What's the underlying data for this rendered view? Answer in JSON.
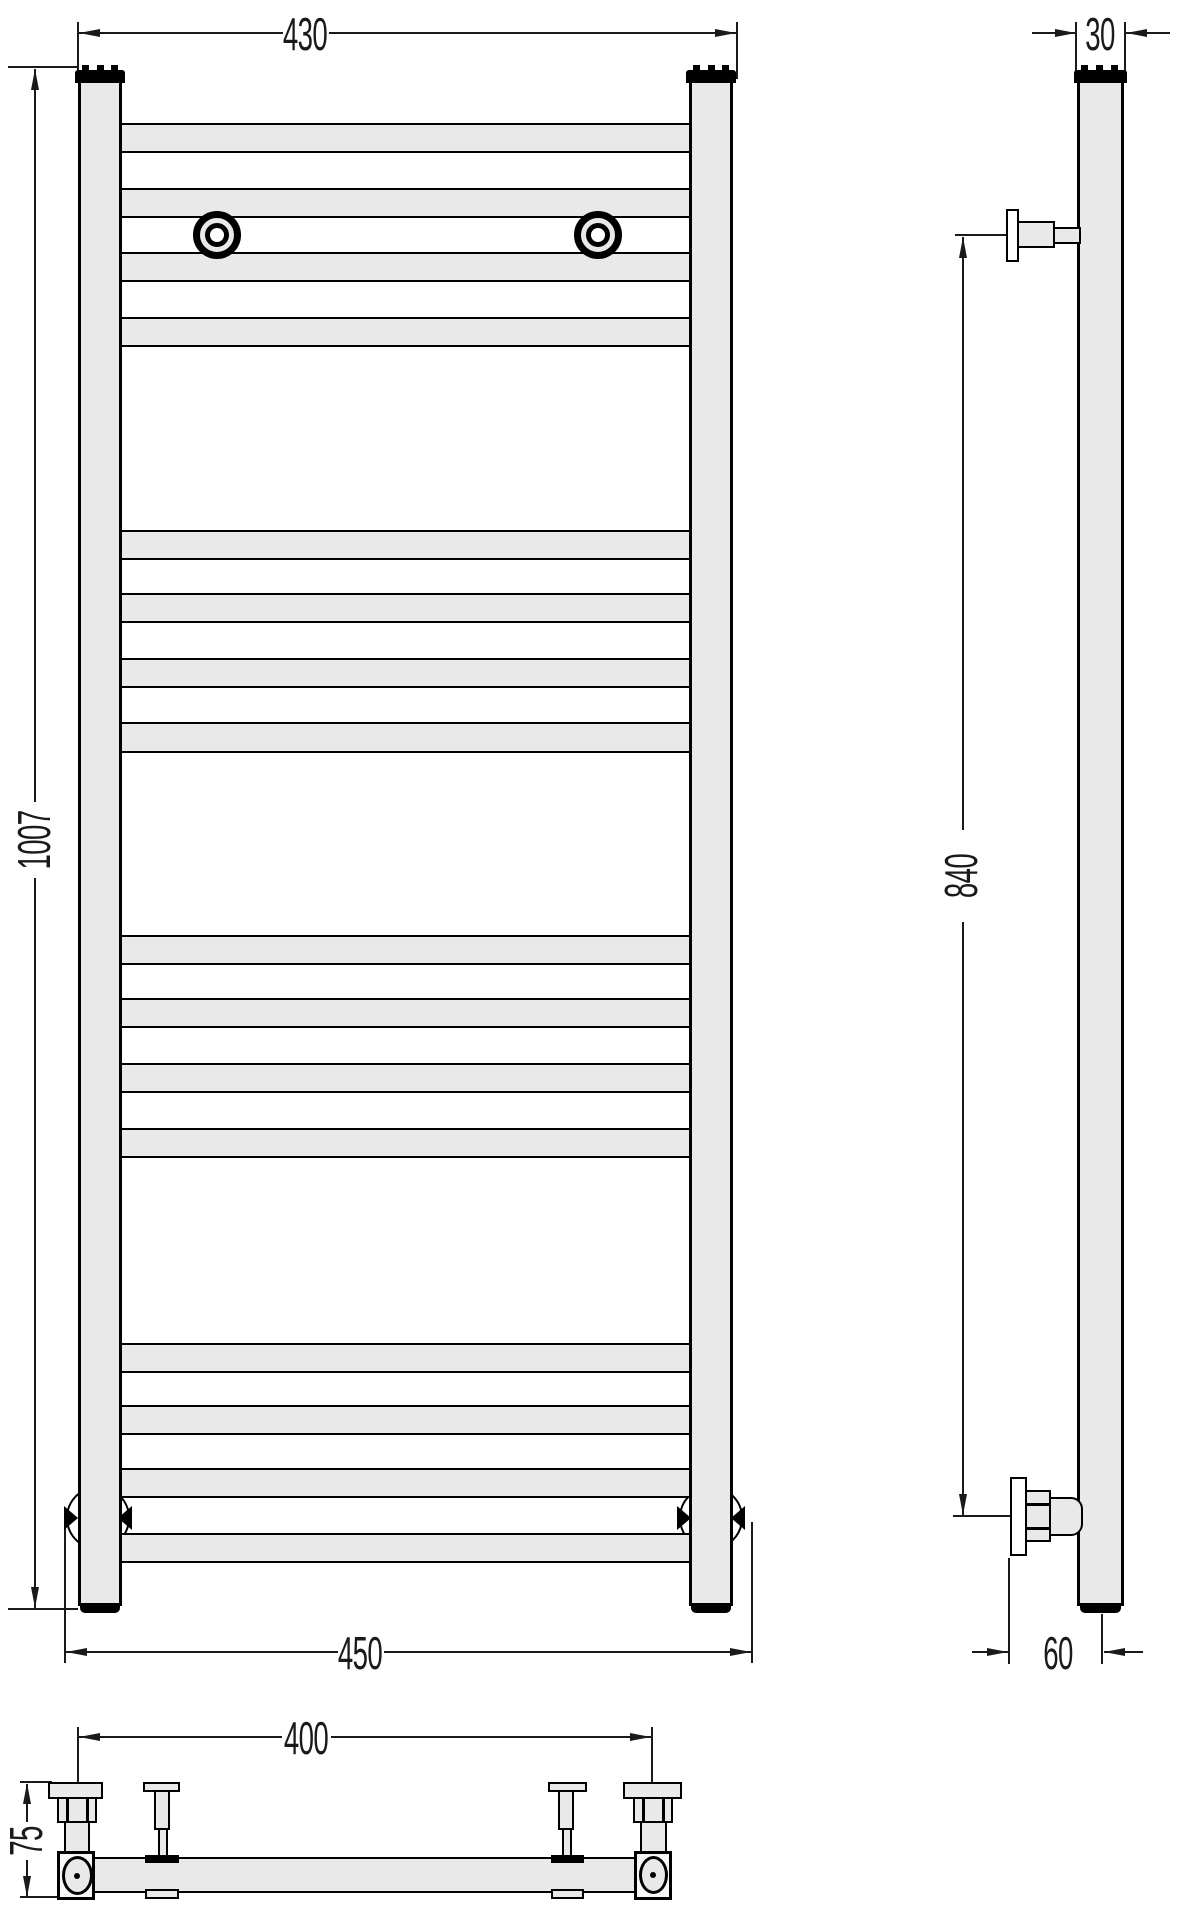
{
  "dimensions": {
    "front": {
      "top_width": "430",
      "height": "1007",
      "bottom_width": "450"
    },
    "side": {
      "tube_depth": "30",
      "bracket_span": "840",
      "wall_offset": "60"
    },
    "bottom": {
      "bracket_spacing": "400",
      "depth": "75"
    }
  },
  "colors": {
    "fill": "#e9e9e9",
    "outline": "#000000",
    "dimension": "#1a1a1a",
    "background": "#ffffff"
  }
}
